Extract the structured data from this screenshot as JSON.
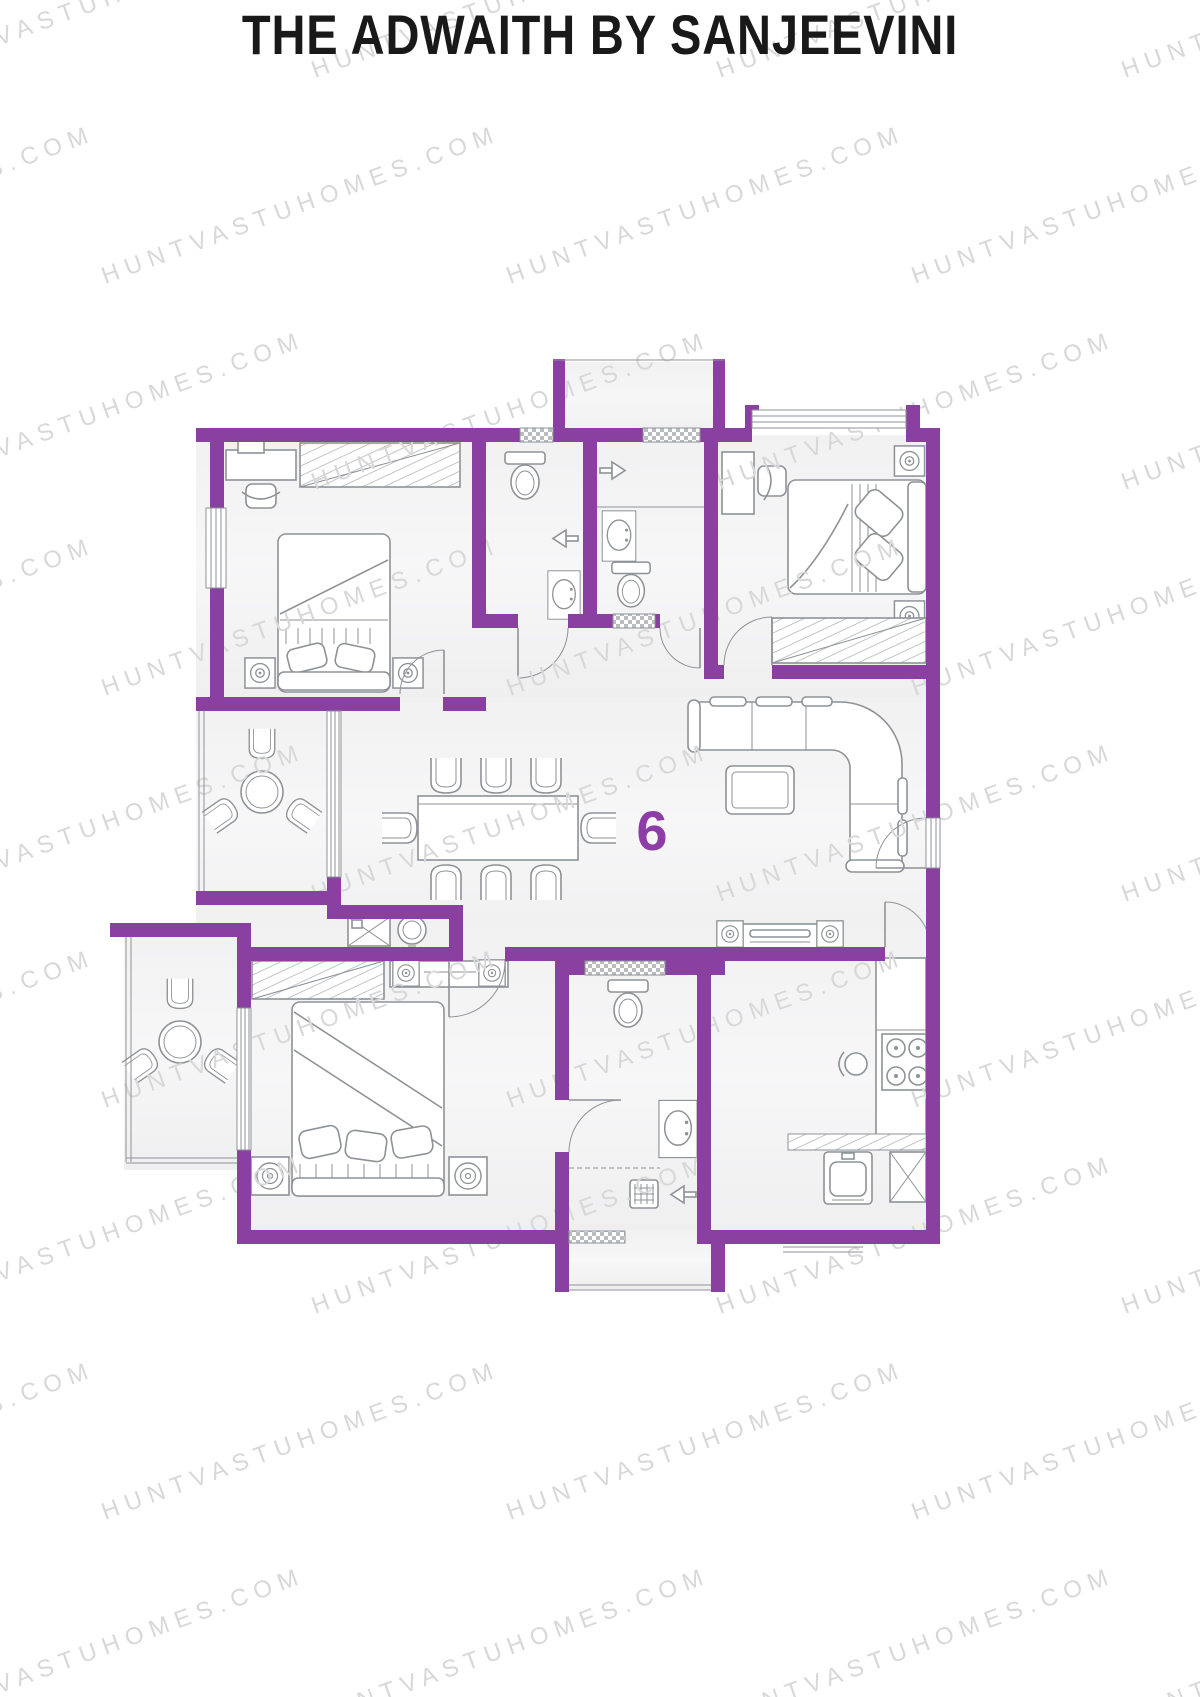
{
  "page": {
    "title": "THE ADWAITH BY SANJEEVINI",
    "watermark": "HUNTVASTUHOMES.COM",
    "unit_number": "6"
  },
  "colors": {
    "wall": "#8a40a0",
    "unit_number": "#8e3da6",
    "watermark": "#d8d8d8",
    "furniture_line": "#8e9297",
    "floor": "#f2f2f3",
    "title_text": "#191919",
    "page_background": "#ffffff"
  }
}
